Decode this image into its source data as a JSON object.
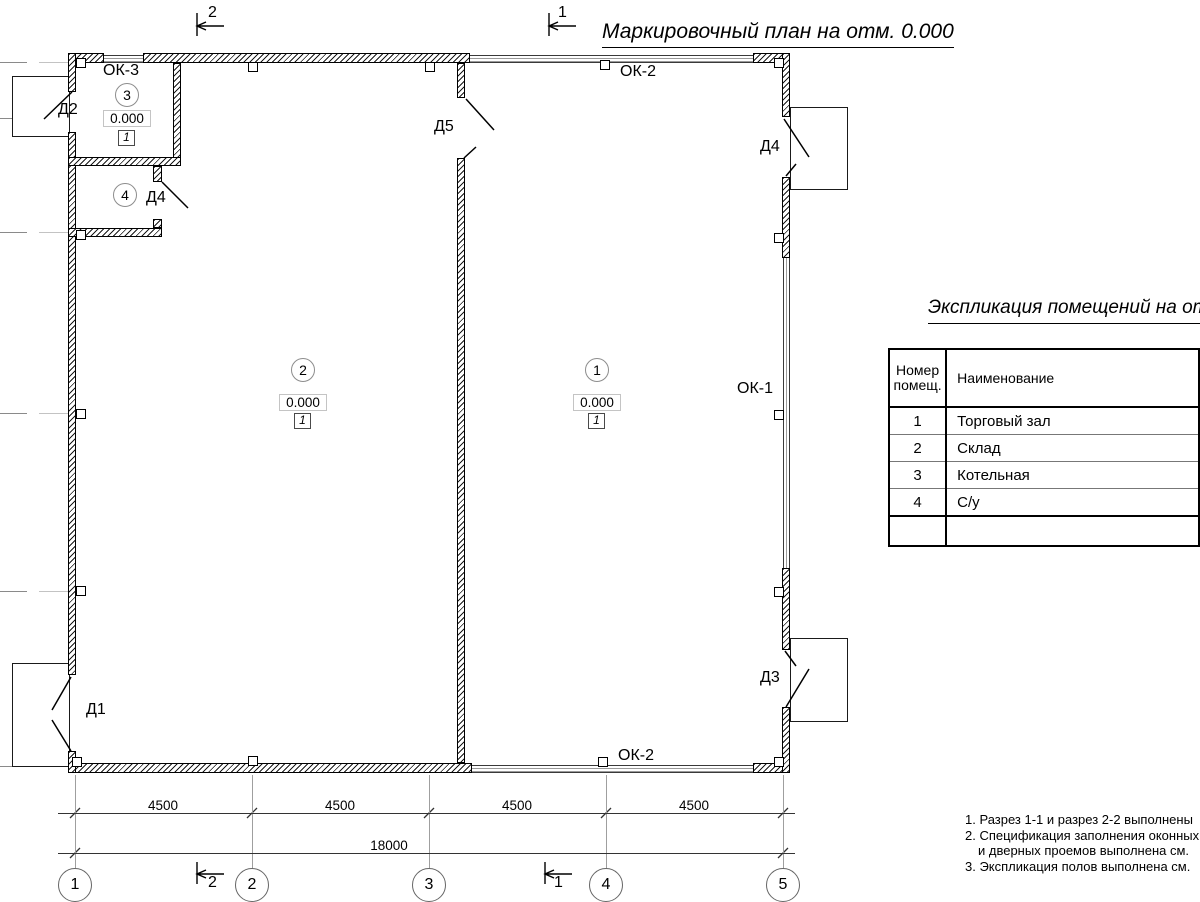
{
  "title": "Маркировочный план на отм. 0.000",
  "section_markers": {
    "top": [
      "2",
      "1"
    ],
    "bottom": [
      "2",
      "1"
    ]
  },
  "plan": {
    "labels": {
      "ok3": "ОК-3",
      "ok2_top": "ОК-2",
      "ok1": "ОК-1",
      "ok2_bottom": "ОК-2",
      "d1": "Д1",
      "d2": "Д2",
      "d3": "Д3",
      "d4_right": "Д4",
      "d4_inner": "Д4",
      "d5": "Д5"
    },
    "rooms": [
      {
        "number": "1",
        "elevation": "0.000",
        "floor_type": "1"
      },
      {
        "number": "2",
        "elevation": "0.000",
        "floor_type": "1"
      },
      {
        "number": "3",
        "elevation": "0.000",
        "floor_type": "1"
      },
      {
        "number": "4",
        "elevation": "0.000",
        "floor_type": "1"
      }
    ]
  },
  "dimensions": {
    "segments": [
      "4500",
      "4500",
      "4500",
      "4500"
    ],
    "total": "18000"
  },
  "grid_axes": [
    "1",
    "2",
    "3",
    "4",
    "5"
  ],
  "table": {
    "title": "Экспликация помещений на от",
    "header": {
      "col1_line1": "Номер",
      "col1_line2": "помещ.",
      "col2": "Наименование"
    },
    "rows": [
      {
        "num": "1",
        "name": "Торговый зал"
      },
      {
        "num": "2",
        "name": "Склад"
      },
      {
        "num": "3",
        "name": "Котельная"
      },
      {
        "num": "4",
        "name": "С/у"
      }
    ]
  },
  "notes": [
    "1. Разрез 1-1 и разрез 2-2 выполнены",
    "2. Спецификация заполнения оконных",
    "и дверных проемов выполнена см.",
    "3. Экспликация полов выполнена см."
  ],
  "colors": {
    "line": "#000000",
    "faint": "#9a9a9a"
  }
}
